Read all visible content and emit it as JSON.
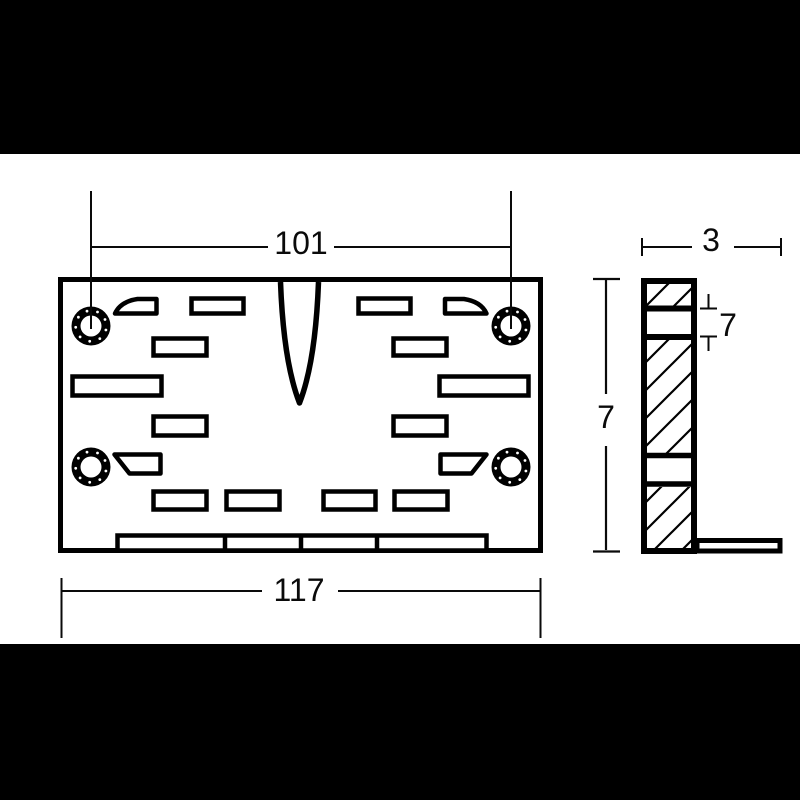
{
  "colors": {
    "background": "#ffffff",
    "letterbox": "#000000",
    "line": "#000000"
  },
  "drawing": {
    "type": "technical-orthographic-drawing",
    "views": [
      "front-view-plate",
      "side-view-l-profile"
    ],
    "dimensions": {
      "front_hole_spacing": "101",
      "front_overall_width": "117",
      "side_depth": "3",
      "side_overall_height": "7",
      "side_slot_height": "7"
    }
  }
}
